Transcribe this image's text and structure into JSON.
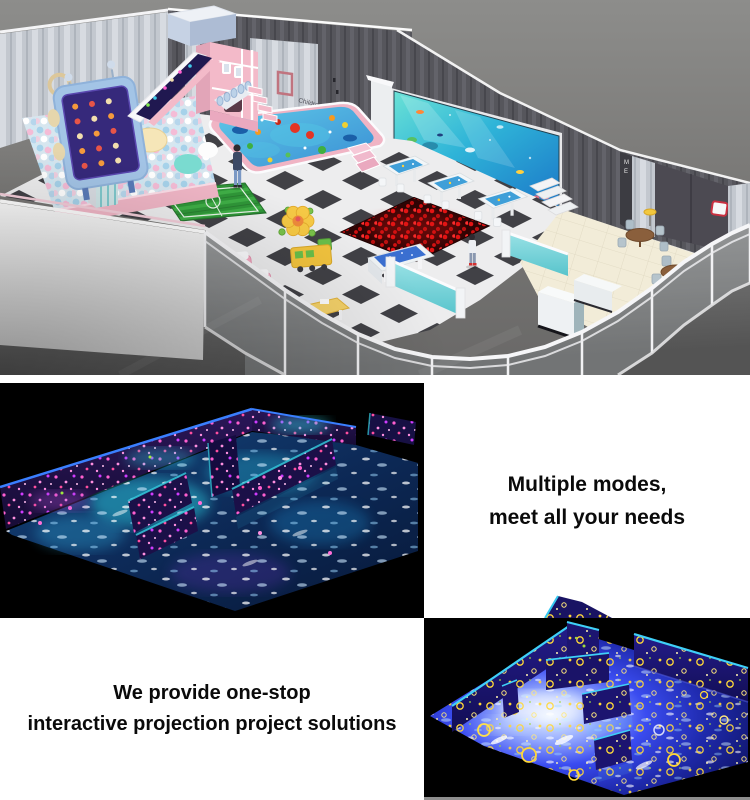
{
  "page": {
    "background": "#ffffff"
  },
  "showroom": {
    "wall_sign": [
      "Children's",
      "Paradise"
    ],
    "elevator_letters": [
      "M",
      "E"
    ],
    "door_label": "Para",
    "colors": {
      "background_gray": "#7d7d7d",
      "wall_dark": "#56565c",
      "wall_light_stripe": "#c7cbd2",
      "checker_dark": "#414146",
      "checker_light": "#ededee",
      "slide_pink": "#f3bac9",
      "ball_pit_pastel": "#a8d4ea",
      "pool_ocean_blue": "#4aa8e0",
      "red_ball_pit": "#e01414",
      "soccer_green": "#2f9638",
      "counter_teal": "#63ccd4",
      "cafe_floor_beige": "#f2ecd8",
      "screen_ocean_teal": "#35c2d8"
    }
  },
  "modes": {
    "caption_line1": "Multiple modes,",
    "caption_line2": "meet all your needs",
    "image_colors": {
      "background": "#000000",
      "floor_glow_cyan": "#35d0e8",
      "splash_magenta": "#ff5fd0",
      "wall_navy": "#1c1048",
      "edge_blue": "#3a7fff"
    }
  },
  "solutions": {
    "caption_line1": "We provide one-stop",
    "caption_line2": "interactive projection project solutions",
    "image_colors": {
      "background": "#000000",
      "floor_blue": "#2f3fe8",
      "glow_white": "#cfe2ff",
      "flower_yellow": "#ffd838",
      "edge_cyan": "#3fd0f8",
      "wall_navy": "#1b1670"
    }
  }
}
